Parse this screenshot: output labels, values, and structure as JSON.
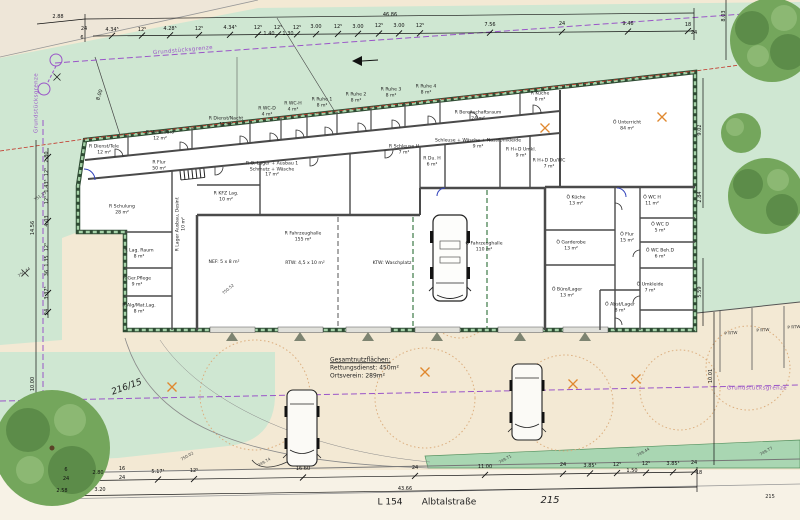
{
  "drawing": {
    "type": "site-floor-plan",
    "street": "L 154 Albtalstraße",
    "site_parcel": "215",
    "neighbor_parcel": "216/15",
    "boundary_label": "Grundstücksgrenze",
    "summary": {
      "title": "Gesamtnutzflächen:",
      "rettungsdienst": "Rettungsdienst: 450m²",
      "ortsverein": "Ortsverein: 289m²"
    },
    "colors": {
      "grass": "#cfe7d2",
      "paving": "#f3e9d4",
      "verge": "#a9d6b2",
      "wall_green": "#2e4b33",
      "wall_hatch": "#a5d2a8",
      "boundary_purple": "#9a55c8",
      "red_line": "#c23327",
      "orange": "#e0882f",
      "tree_green": "#74a65c"
    }
  },
  "rooms": [
    {
      "lines": [
        "R Dienst/Tele",
        "12 m²"
      ],
      "x": 104,
      "y": 150
    },
    {
      "lines": [
        "R Verw/Büro",
        "12 m²"
      ],
      "x": 160,
      "y": 136
    },
    {
      "lines": [
        "R Dienst/Nacht",
        "12 m²"
      ],
      "x": 226,
      "y": 122
    },
    {
      "lines": [
        "R WC-D",
        "4 m²"
      ],
      "x": 267,
      "y": 112
    },
    {
      "lines": [
        "R WC-H",
        "4 m²"
      ],
      "x": 293,
      "y": 107
    },
    {
      "lines": [
        "R Ruhe 1",
        "8 m²"
      ],
      "x": 322,
      "y": 103
    },
    {
      "lines": [
        "R Ruhe 2",
        "8 m²"
      ],
      "x": 356,
      "y": 98
    },
    {
      "lines": [
        "R Ruhe 3",
        "8 m²"
      ],
      "x": 391,
      "y": 93
    },
    {
      "lines": [
        "R Ruhe 4",
        "8 m²"
      ],
      "x": 426,
      "y": 90
    },
    {
      "lines": [
        "R Bereitschaftsraum",
        "24 m²"
      ],
      "x": 478,
      "y": 116
    },
    {
      "lines": [
        "R Küche",
        "8 m²"
      ],
      "x": 540,
      "y": 97
    },
    {
      "lines": [
        "Ö Unterricht",
        "84 m²"
      ],
      "x": 627,
      "y": 126
    },
    {
      "lines": [
        "R Flur",
        "50 m²"
      ],
      "x": 159,
      "y": 166
    },
    {
      "lines": [
        "R O. Lager + Ausbau 1",
        "Schmutz + Wäsche",
        "17 m²"
      ],
      "x": 272,
      "y": 170
    },
    {
      "lines": [
        "R Schulung",
        "28 m²"
      ],
      "x": 122,
      "y": 210
    },
    {
      "lines": [
        "R KFZ Lag.",
        "10 m²"
      ],
      "x": 226,
      "y": 197
    },
    {
      "lines": [
        "R Lager Ausbau, Desinf.",
        "10 m²"
      ],
      "x": 181,
      "y": 224,
      "r": -90
    },
    {
      "lines": [
        "R Lag. Raum",
        "8 m²"
      ],
      "x": 139,
      "y": 254
    },
    {
      "lines": [
        "R Ger.Pflege",
        "9 m²"
      ],
      "x": 137,
      "y": 282
    },
    {
      "lines": [
        "R Alg/Mat.Lag.",
        "8 m²"
      ],
      "x": 139,
      "y": 309
    },
    {
      "lines": [
        "R Schleuse H",
        "7 m²"
      ],
      "x": 404,
      "y": 150
    },
    {
      "lines": [
        "R Du. H",
        "6 m²"
      ],
      "x": 432,
      "y": 162
    },
    {
      "lines": [
        "Schleuse + Wäsche + Nass/Umkleide",
        "9 m²"
      ],
      "x": 478,
      "y": 144
    },
    {
      "lines": [
        "R H+D Umkl.",
        "9 m²"
      ],
      "x": 521,
      "y": 153
    },
    {
      "lines": [
        "R H+D Du/WC",
        "7 m²"
      ],
      "x": 549,
      "y": 164
    },
    {
      "lines": [
        "R Fahrzeughalle",
        "155 m²"
      ],
      "x": 303,
      "y": 237
    },
    {
      "lines": [
        "NEF: 5 x 8 m²"
      ],
      "x": 224,
      "y": 263
    },
    {
      "lines": [
        "RTW: 4,5 x 10 m²"
      ],
      "x": 305,
      "y": 264
    },
    {
      "lines": [
        "KTW: Waschplatz"
      ],
      "x": 392,
      "y": 264
    },
    {
      "lines": [
        "Ö Fahrzeughalle",
        "110 m²"
      ],
      "x": 484,
      "y": 247
    },
    {
      "lines": [
        "Ö Küche",
        "13 m²"
      ],
      "x": 576,
      "y": 201
    },
    {
      "lines": [
        "Ö WC H",
        "11 m²"
      ],
      "x": 652,
      "y": 201
    },
    {
      "lines": [
        "Ö WC D",
        "5 m²"
      ],
      "x": 660,
      "y": 228
    },
    {
      "lines": [
        "Ö Garderobe",
        "13 m²"
      ],
      "x": 571,
      "y": 246
    },
    {
      "lines": [
        "Ö Flur",
        "15 m²"
      ],
      "x": 627,
      "y": 238
    },
    {
      "lines": [
        "Ö WC Beh.D",
        "6 m²"
      ],
      "x": 660,
      "y": 254
    },
    {
      "lines": [
        "Ö Büro/Lager",
        "13 m²"
      ],
      "x": 567,
      "y": 293
    },
    {
      "lines": [
        "Ö Umkleide",
        "7 m²"
      ],
      "x": 650,
      "y": 288
    },
    {
      "lines": [
        "Ö Abst/Lager",
        "8 m²"
      ],
      "x": 620,
      "y": 308
    }
  ],
  "dims_top": [
    {
      "t": "2.88",
      "x": 58,
      "y": 17
    },
    {
      "t": "46.86",
      "x": 390,
      "y": 15
    },
    {
      "t": "24",
      "x": 84,
      "y": 29
    },
    {
      "t": "6",
      "x": 82,
      "y": 38
    },
    {
      "t": "4.34⁵",
      "x": 112,
      "y": 30,
      "k": 1
    },
    {
      "t": "12⁵",
      "x": 142,
      "y": 30,
      "k": 1
    },
    {
      "t": "4.28⁵",
      "x": 170,
      "y": 29,
      "k": 1
    },
    {
      "t": "12⁵",
      "x": 199,
      "y": 29,
      "k": 1
    },
    {
      "t": "4.34⁵",
      "x": 230,
      "y": 28,
      "k": 1
    },
    {
      "t": "12⁵",
      "x": 258,
      "y": 28,
      "k": 1
    },
    {
      "t": "1.40",
      "x": 269,
      "y": 34
    },
    {
      "t": "12⁵",
      "x": 278,
      "y": 28,
      "k": 1
    },
    {
      "t": "1.30",
      "x": 288,
      "y": 34
    },
    {
      "t": "12⁵",
      "x": 297,
      "y": 28,
      "k": 1
    },
    {
      "t": "3.00",
      "x": 316,
      "y": 27,
      "k": 1
    },
    {
      "t": "12⁵",
      "x": 338,
      "y": 27,
      "k": 1
    },
    {
      "t": "3.00",
      "x": 358,
      "y": 27,
      "k": 1
    },
    {
      "t": "12⁵",
      "x": 379,
      "y": 26,
      "k": 1
    },
    {
      "t": "3.00",
      "x": 399,
      "y": 26,
      "k": 1
    },
    {
      "t": "12⁵",
      "x": 420,
      "y": 26,
      "k": 1
    },
    {
      "t": "7.56",
      "x": 490,
      "y": 25,
      "k": 1
    },
    {
      "t": "24",
      "x": 562,
      "y": 24,
      "k": 1
    },
    {
      "t": "9.46",
      "x": 628,
      "y": 24,
      "k": 1
    },
    {
      "t": "18",
      "x": 688,
      "y": 25,
      "k": 1
    },
    {
      "t": "24",
      "x": 694,
      "y": 33
    }
  ],
  "dims_left": [
    {
      "t": "8.00",
      "x": 100,
      "y": 95,
      "r": -72
    },
    {
      "t": "2.80",
      "x": 47,
      "y": 157,
      "r": -90,
      "k": 2
    },
    {
      "t": "12⁵",
      "x": 47,
      "y": 172,
      "r": -90
    },
    {
      "t": "1.43⁵",
      "x": 47,
      "y": 186,
      "r": -90
    },
    {
      "t": "12⁵",
      "x": 47,
      "y": 200,
      "r": -90
    },
    {
      "t": "4.03",
      "x": 47,
      "y": 221,
      "r": -90,
      "k": 2
    },
    {
      "t": "14.56",
      "x": 33,
      "y": 228,
      "r": -90
    },
    {
      "t": "12⁵",
      "x": 47,
      "y": 247,
      "r": -90
    },
    {
      "t": "1.35",
      "x": 47,
      "y": 261,
      "r": -90
    },
    {
      "t": "36",
      "x": 47,
      "y": 273,
      "r": -90
    },
    {
      "t": "3.37⁵",
      "x": 47,
      "y": 293,
      "r": -90,
      "k": 2
    },
    {
      "t": "24",
      "x": 47,
      "y": 312,
      "r": -90,
      "k": 2
    },
    {
      "t": "10.00",
      "x": 33,
      "y": 384,
      "r": -90
    }
  ],
  "dims_right": [
    {
      "t": "8.03",
      "x": 724,
      "y": 16,
      "r": -90
    },
    {
      "t": "9.02",
      "x": 700,
      "y": 130,
      "r": -90
    },
    {
      "t": "2.84",
      "x": 700,
      "y": 197,
      "r": -90
    },
    {
      "t": "5.59",
      "x": 700,
      "y": 292,
      "r": -90
    },
    {
      "t": "10.01",
      "x": 711,
      "y": 376,
      "r": -90
    }
  ],
  "dims_bottom": [
    {
      "t": "6",
      "x": 66,
      "y": 470
    },
    {
      "t": "24",
      "x": 66,
      "y": 479
    },
    {
      "t": "2.80",
      "x": 98,
      "y": 473,
      "k": 1
    },
    {
      "t": "16",
      "x": 122,
      "y": 469
    },
    {
      "t": "24",
      "x": 122,
      "y": 478
    },
    {
      "t": "5.17¹",
      "x": 158,
      "y": 472,
      "k": 1
    },
    {
      "t": "12⁵",
      "x": 194,
      "y": 471,
      "k": 1
    },
    {
      "t": "16.60",
      "x": 303,
      "y": 469,
      "k": 1
    },
    {
      "t": "24",
      "x": 415,
      "y": 468,
      "k": 1
    },
    {
      "t": "11.00",
      "x": 485,
      "y": 467,
      "k": 1
    },
    {
      "t": "24",
      "x": 563,
      "y": 465,
      "k": 1
    },
    {
      "t": "3.85¹",
      "x": 590,
      "y": 466,
      "k": 1
    },
    {
      "t": "12⁵",
      "x": 617,
      "y": 465,
      "k": 1
    },
    {
      "t": "1.50",
      "x": 632,
      "y": 471
    },
    {
      "t": "12⁵",
      "x": 646,
      "y": 464,
      "k": 1
    },
    {
      "t": "3.85¹",
      "x": 673,
      "y": 464,
      "k": 1
    },
    {
      "t": "24",
      "x": 694,
      "y": 463,
      "k": 1
    },
    {
      "t": "18",
      "x": 699,
      "y": 473
    },
    {
      "t": "2.58",
      "x": 62,
      "y": 491
    },
    {
      "t": "3.20",
      "x": 100,
      "y": 490
    },
    {
      "t": "43.66",
      "x": 405,
      "y": 489
    }
  ],
  "annotations": [
    {
      "t": "Gesamtnutzflächen:",
      "x": 330,
      "y": 360,
      "s": 6,
      "a": "l",
      "u": 1
    },
    {
      "t": "Rettungsdienst: 450m²",
      "x": 330,
      "y": 368,
      "s": 6,
      "a": "l"
    },
    {
      "t": "Ortsverein: 289m²",
      "x": 330,
      "y": 376,
      "s": 6,
      "a": "l"
    },
    {
      "t": "L 154",
      "x": 390,
      "y": 503,
      "s": 9
    },
    {
      "t": "Albtalstraße",
      "x": 449,
      "y": 503,
      "s": 9
    },
    {
      "t": "215",
      "x": 550,
      "y": 501,
      "s": 10,
      "i": 1
    },
    {
      "t": "215",
      "x": 770,
      "y": 497,
      "s": 5
    },
    {
      "t": "216/15",
      "x": 127,
      "y": 388,
      "s": 9,
      "i": 1,
      "r": -20
    }
  ],
  "boundaries": [
    {
      "t": "Grundstücksgrenze",
      "x": 183,
      "y": 51,
      "r": -5
    },
    {
      "t": "Grundstücksgrenze",
      "x": 37,
      "y": 103,
      "r": -90
    },
    {
      "t": "Grundstücksgrenze",
      "x": 757,
      "y": 389
    }
  ],
  "parking": [
    {
      "t": "P RTW",
      "x": 731,
      "y": 333,
      "r": -4
    },
    {
      "t": "P RTW",
      "x": 763,
      "y": 330,
      "r": -4
    },
    {
      "t": "P RTW",
      "x": 794,
      "y": 327,
      "r": -4
    }
  ],
  "spot_heights": [
    {
      "t": "750.02",
      "x": 187,
      "y": 456,
      "r": -30
    },
    {
      "t": "749.74",
      "x": 264,
      "y": 462,
      "r": -30
    },
    {
      "t": "749.71",
      "x": 505,
      "y": 459,
      "r": -30
    },
    {
      "t": "749.44",
      "x": 643,
      "y": 452,
      "r": -30
    },
    {
      "t": "749.77",
      "x": 766,
      "y": 451,
      "r": -30
    },
    {
      "t": "750.52",
      "x": 228,
      "y": 289,
      "r": -40
    },
    {
      "t": "751.35",
      "x": 40,
      "y": 196,
      "r": -35
    },
    {
      "t": "750.44",
      "x": 24,
      "y": 272,
      "r": -35
    }
  ],
  "crosses": [
    [
      662,
      117
    ],
    [
      425,
      372
    ],
    [
      573,
      384
    ],
    [
      636,
      379
    ],
    [
      172,
      387
    ],
    [
      545,
      128
    ]
  ],
  "survey_marks": [
    [
      57,
      77
    ],
    [
      25,
      273
    ],
    [
      80,
      440
    ]
  ]
}
